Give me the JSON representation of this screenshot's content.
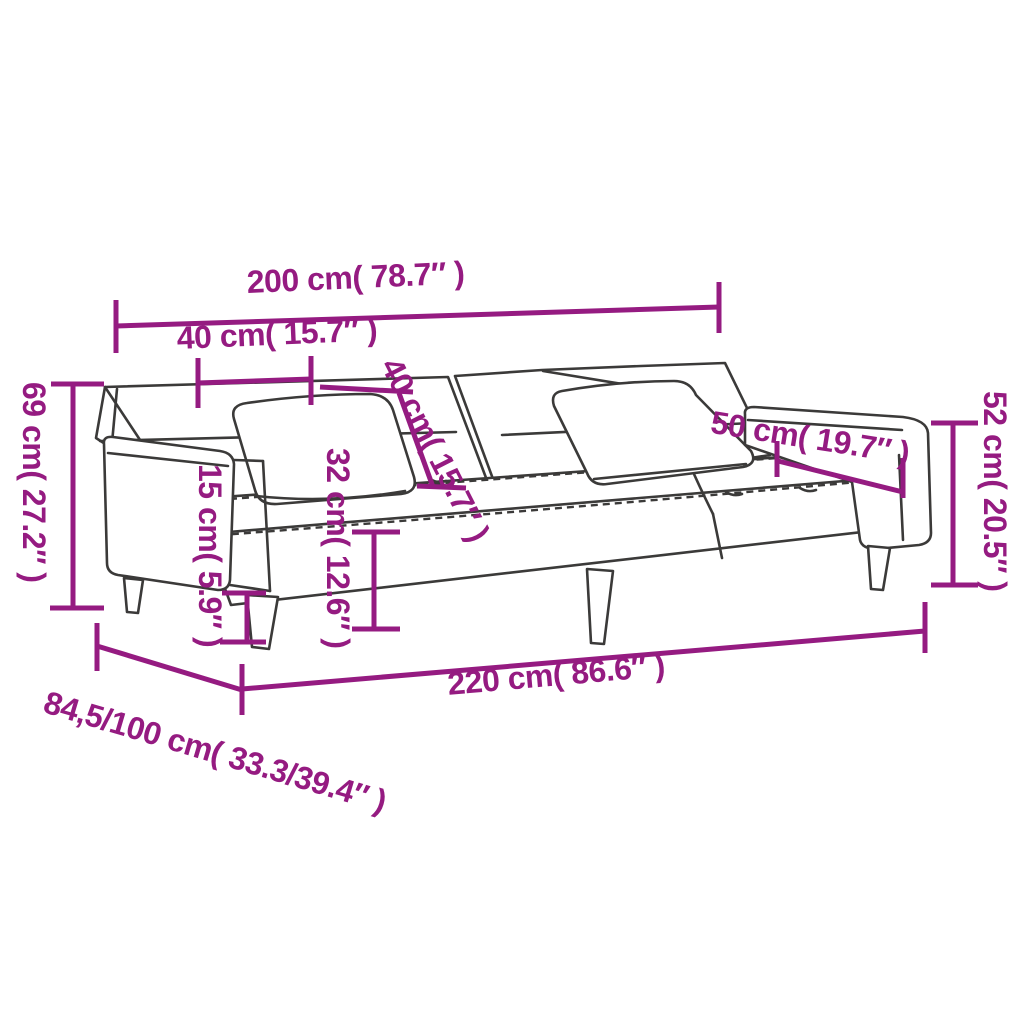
{
  "colors": {
    "accent": "#951b81",
    "line": "#3b3a39",
    "background": "#ffffff"
  },
  "diagram": {
    "subject": "sofa-bed line drawing with dimension annotations"
  },
  "dimensions": {
    "top_width": "200 cm( 78.7″ )",
    "armrest_top_width": "40 cm( 15.7″ )",
    "backrest_diagonal": "40 cm( 15.7″ )",
    "left_height": "69 cm( 27.2″ )",
    "leg_height": "15 cm( 5.9″ )",
    "seat_height": "32 cm( 12.6″ )",
    "armrest_length": "50 cm( 19.7″ )",
    "right_height": "52 cm( 20.5″ )",
    "bottom_width": "220 cm( 86.6″ )",
    "depth_range": "84,5/100 cm( 33.3/39.4″ )"
  }
}
